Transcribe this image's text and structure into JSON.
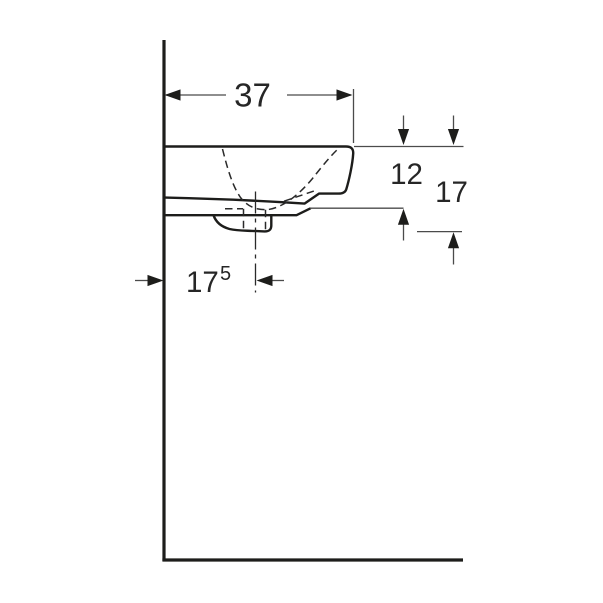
{
  "drawing": {
    "colors": {
      "line": "#1d1d1b",
      "thin": "#4b4b4b",
      "text": "#262626",
      "background": "#ffffff"
    },
    "dimensions": {
      "basin_depth": {
        "value": "37"
      },
      "rim_to_underside": {
        "value": "12"
      },
      "rim_to_trap_bottom": {
        "value": "17"
      },
      "wall_to_drain_center": {
        "value": "17",
        "sup_value": "5"
      }
    }
  }
}
